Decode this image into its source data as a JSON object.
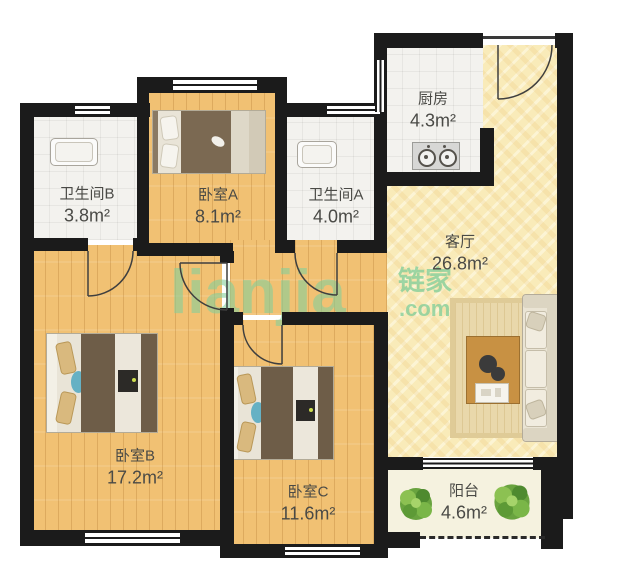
{
  "watermark": {
    "brand_latin": "lianjia",
    "brand_cn": "链家",
    "suffix": ".com"
  },
  "rooms": [
    {
      "id": "bathroom-b",
      "name": "卫生间B",
      "area": "3.8m²"
    },
    {
      "id": "bedroom-a",
      "name": "卧室A",
      "area": "8.1m²"
    },
    {
      "id": "bathroom-a",
      "name": "卫生间A",
      "area": "4.0m²"
    },
    {
      "id": "kitchen",
      "name": "厨房",
      "area": "4.3m²"
    },
    {
      "id": "living-room",
      "name": "客厅",
      "area": "26.8m²"
    },
    {
      "id": "bedroom-b",
      "name": "卧室B",
      "area": "17.2m²"
    },
    {
      "id": "bedroom-c",
      "name": "卧室C",
      "area": "11.6m²"
    },
    {
      "id": "balcony",
      "name": "阳台",
      "area": "4.6m²"
    }
  ],
  "colors": {
    "wall": "#1b1b1b",
    "wood_floor": "#f1c173",
    "living_floor": "#f9ebb9",
    "tile_floor": "#f3f2ee",
    "balcony_floor": "#f5f2df",
    "watermark_green": "#86cf9a",
    "label_text": "#4a4a46"
  }
}
